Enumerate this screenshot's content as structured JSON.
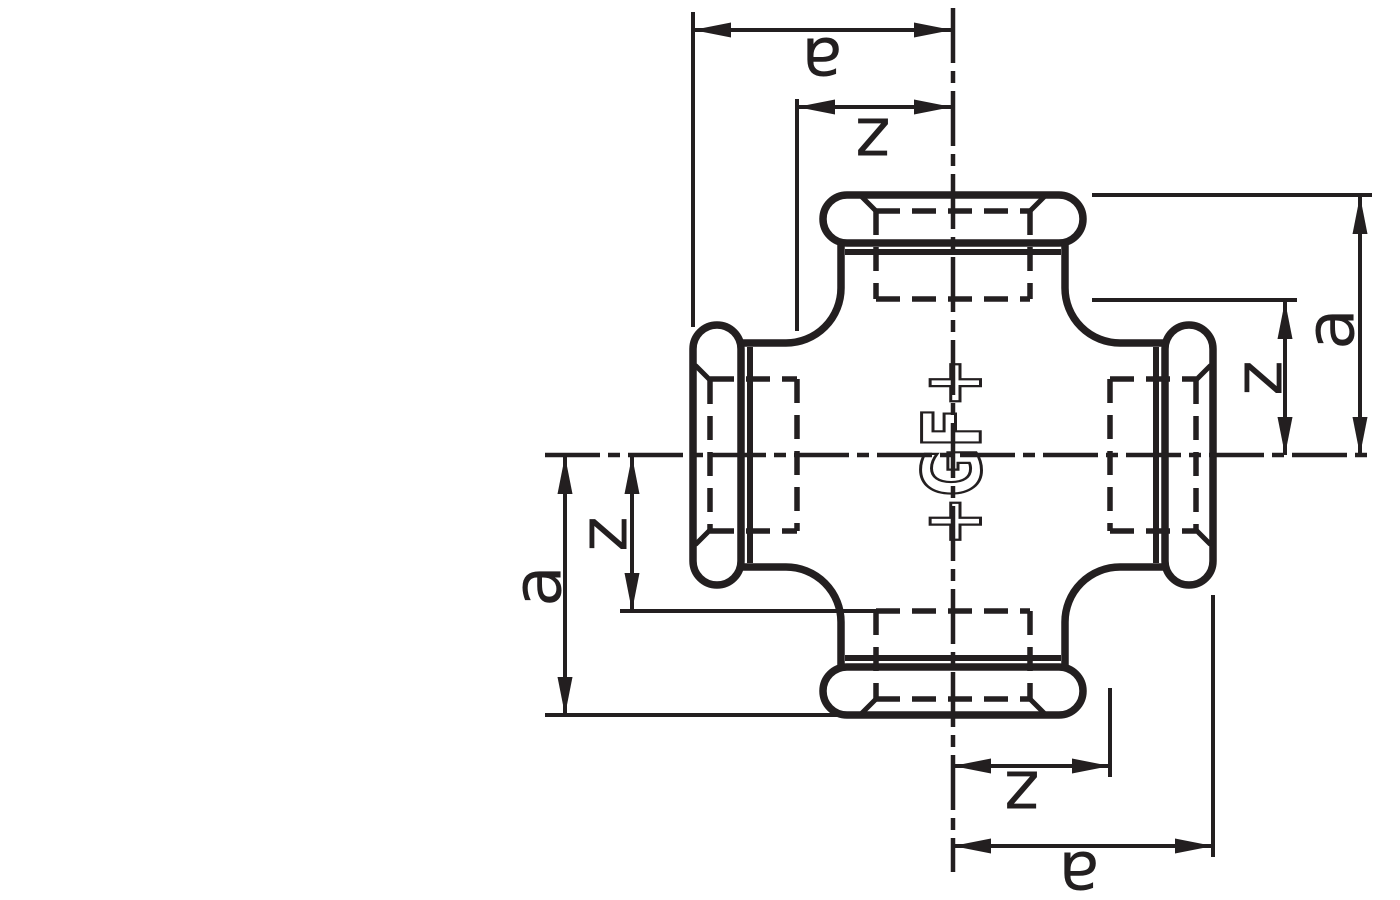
{
  "colors": {
    "ink": "#231f20",
    "background": "#ffffff"
  },
  "center_logo": {
    "text": "+GF+"
  },
  "dimension_labels": {
    "top": {
      "center_to_face": "a",
      "center_to_thread": "z"
    },
    "right": {
      "center_to_face": "a",
      "center_to_thread": "z"
    },
    "left": {
      "center_to_face": "a",
      "center_to_thread": "z"
    },
    "bottom": {
      "center_to_face": "a",
      "center_to_thread": "z"
    }
  }
}
